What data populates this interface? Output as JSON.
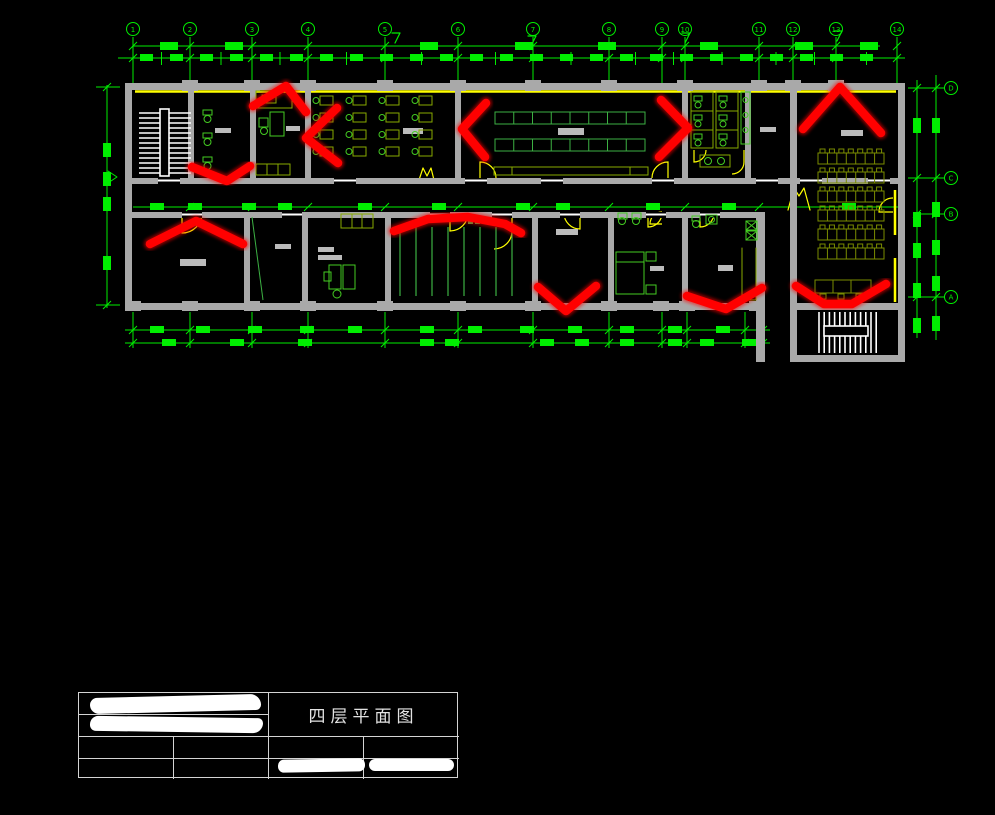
{
  "canvas": {
    "background": "#000000"
  },
  "colors": {
    "dim_green": "#00ee00",
    "furniture_green": "#44cc22",
    "desk_olive": "#88aa00",
    "table_olive": "#7a8c00",
    "assembly_green": "#3cb043",
    "wall_gray": "#a9a9a9",
    "label_gray": "#bbbbbb",
    "window_yellow": "#ffff00",
    "annotation_red": "#ff0000",
    "stair_white": "#ffffff"
  },
  "plan": {
    "grid_top_labels": [
      "1",
      "2",
      "3",
      "4",
      "5",
      "6",
      "7",
      "8",
      "9",
      "10",
      "11",
      "12",
      "13",
      "14"
    ],
    "grid_right_labels": [
      "D",
      "C",
      "B",
      "A"
    ],
    "red_marks": [
      {
        "points": [
          [
            253,
            106
          ],
          [
            286,
            86
          ],
          [
            306,
            112
          ]
        ]
      },
      {
        "points": [
          [
            337,
            108
          ],
          [
            306,
            138
          ],
          [
            338,
            163
          ]
        ]
      },
      {
        "points": [
          [
            192,
            167
          ],
          [
            227,
            181
          ],
          [
            250,
            166
          ]
        ]
      },
      {
        "points": [
          [
            486,
            103
          ],
          [
            462,
            129
          ],
          [
            485,
            157
          ]
        ]
      },
      {
        "points": [
          [
            661,
            100
          ],
          [
            688,
            128
          ],
          [
            659,
            157
          ]
        ]
      },
      {
        "points": [
          [
            803,
            129
          ],
          [
            840,
            87
          ],
          [
            881,
            133
          ]
        ]
      },
      {
        "points": [
          [
            150,
            244
          ],
          [
            196,
            221
          ],
          [
            243,
            244
          ]
        ]
      },
      {
        "points": [
          [
            394,
            231
          ],
          [
            428,
            219
          ],
          [
            468,
            217
          ],
          [
            505,
            224
          ],
          [
            521,
            233
          ]
        ]
      },
      {
        "points": [
          [
            538,
            287
          ],
          [
            566,
            311
          ],
          [
            596,
            286
          ]
        ]
      },
      {
        "points": [
          [
            687,
            296
          ],
          [
            726,
            309
          ],
          [
            762,
            288
          ]
        ]
      },
      {
        "points": [
          [
            796,
            286
          ],
          [
            824,
            304
          ],
          [
            852,
            304
          ],
          [
            886,
            284
          ]
        ]
      }
    ]
  },
  "title_block": {
    "drawing_title": "四层平面图"
  }
}
